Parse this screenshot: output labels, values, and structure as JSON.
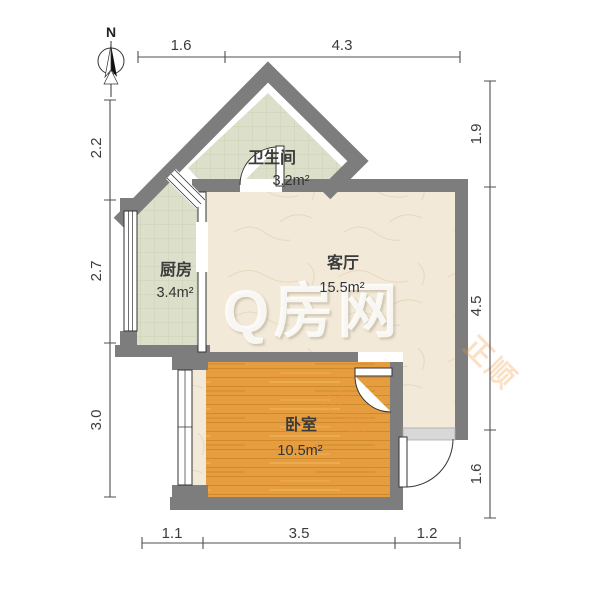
{
  "compass": {
    "label": "N"
  },
  "rooms": {
    "bathroom": {
      "name": "卫生间",
      "area": "3.2m²"
    },
    "kitchen": {
      "name": "厨房",
      "area": "3.4m²"
    },
    "living": {
      "name": "客厅",
      "area": "15.5m²"
    },
    "bedroom": {
      "name": "卧室",
      "area": "10.5m²"
    }
  },
  "dimensions": {
    "top": [
      "1.6",
      "4.3"
    ],
    "left": [
      "2.2",
      "2.7",
      "3.0"
    ],
    "right": [
      "1.9",
      "4.5",
      "1.6"
    ],
    "bottom": [
      "1.1",
      "3.5",
      "1.2"
    ]
  },
  "watermark": {
    "brand": "Q房网",
    "agency": "正顺"
  },
  "colors": {
    "wall": "#7d7d7d",
    "wood_floor": "#e59d40",
    "tile_floor": "#dce0ca",
    "marble_floor": "#f2e9d8",
    "threshold": "#d8d8d8",
    "dimension_line": "#4f4f4f"
  }
}
